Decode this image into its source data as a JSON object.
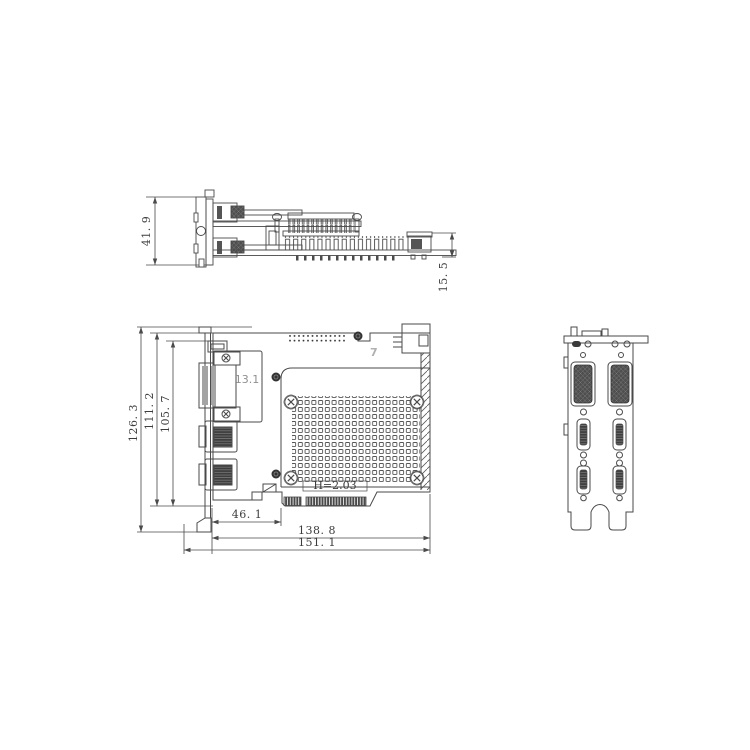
{
  "colors": {
    "background": "#ffffff",
    "line": "#4a4a4a",
    "dark_fill": "#3e3e3e",
    "silkscreen_gray": "#b0b0b0",
    "dimension_text": "#3c3c3c"
  },
  "views": {
    "side_profile": {
      "dimensions": {
        "bracket_height": "41. 9",
        "component_height": "15. 5"
      }
    },
    "front": {
      "dimensions": {
        "overall_height": "126. 3",
        "board_height": "111. 2",
        "tab_height": "105. 7",
        "edge_key_offset": "46. 1",
        "board_length": "138. 8",
        "overall_length": "151. 1"
      },
      "markings": {
        "dvi_connector": "13.1",
        "silkscreen": "7",
        "edge_connector_thickness": "H=2.03"
      }
    },
    "end_bracket": {}
  }
}
